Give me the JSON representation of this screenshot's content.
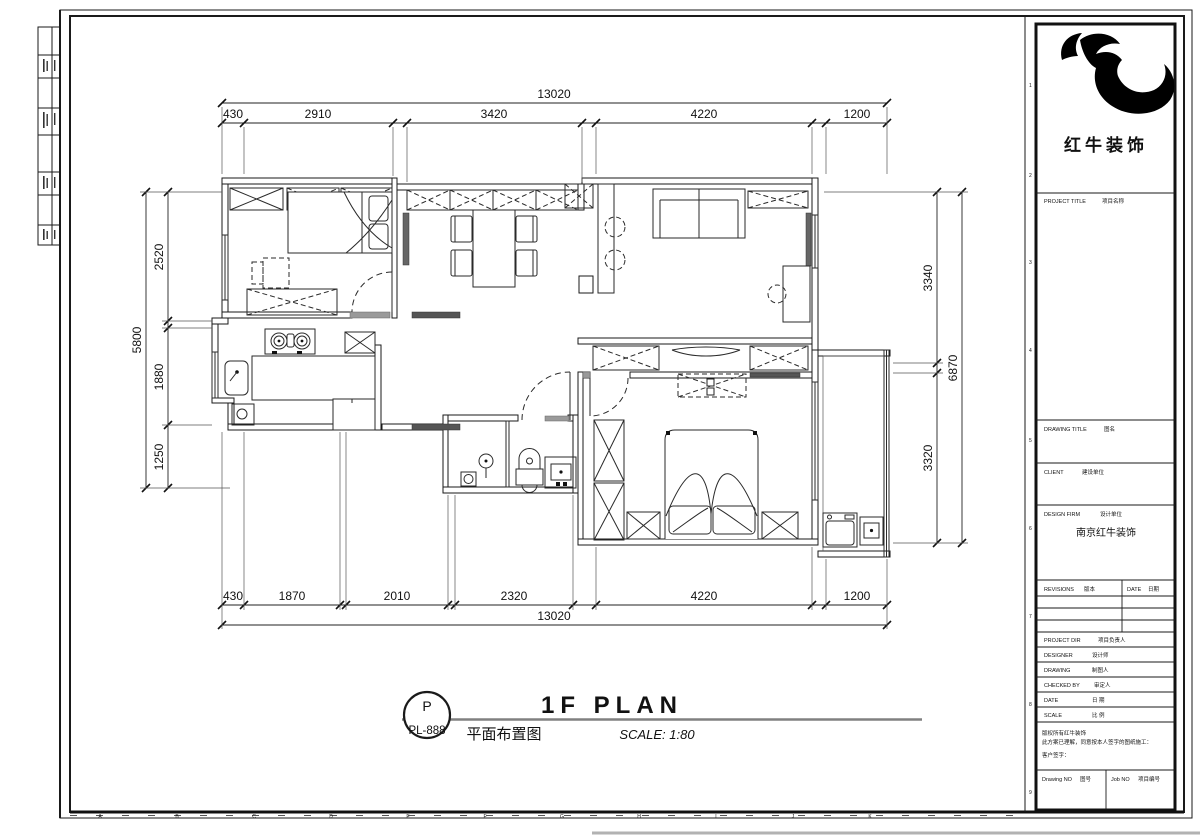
{
  "frame": {
    "ruler_letters": [
      "A",
      "B",
      "C",
      "D",
      "E",
      "F",
      "G",
      "H",
      "I",
      "J",
      "K"
    ],
    "row_numbers": [
      "1",
      "2",
      "3",
      "4",
      "5",
      "6",
      "7",
      "8",
      "9"
    ]
  },
  "plan": {
    "dims": {
      "top_total": "13020",
      "top_segments": [
        "430",
        "2910",
        "3420",
        "4220",
        "1200"
      ],
      "bottom_segments": [
        "430",
        "1870",
        "2010",
        "2320",
        "4220",
        "1200"
      ],
      "bottom_total": "13020",
      "left_total": "5800",
      "left_segments": [
        "2520",
        "1880",
        "1250"
      ],
      "right_segments": [
        "3340",
        "3320"
      ],
      "right_total": "6870"
    }
  },
  "caption": {
    "bubble_top": "P",
    "bubble_bottom": "PL-888",
    "title_en": "1F PLAN",
    "title_cn": "平面布置图",
    "scale": "SCALE: 1:80"
  },
  "titleblock": {
    "logo_text": "红牛装饰",
    "project_title_en": "PROJECT TITLE",
    "project_title_cn": "项目名称",
    "drawing_title_en": "DRAWING TITLE",
    "drawing_title_cn": "图名",
    "client_en": "CLIENT",
    "client_cn": "建设单位",
    "design_firm_en": "DESIGN FIRM",
    "design_firm_cn": "设计单位",
    "design_firm_value": "南京红牛装饰",
    "revisions_en": "REVISIONS",
    "revisions_cn": "版本",
    "date_col_en": "DATE",
    "date_col_cn": "日期",
    "project_dir_en": "PROJECT DIR",
    "project_dir_cn": "项目负责人",
    "designer_en": "DESIGNER",
    "designer_cn": "设计师",
    "drawing_en": "DRAWING",
    "drawing_cn": "制图人",
    "checked_en": "CHECKED BY",
    "checked_cn": "审定人",
    "date_en": "DATE",
    "date_cn": "日 期",
    "scale_en": "SCALE",
    "scale_cn": "比 例",
    "copyright_line1": "版权所有红牛装饰",
    "copyright_line2": "此方案已理解，同意按本人签字的图纸施工：",
    "signature_label": "客户签字：",
    "drawing_no_en": "Drawing NO",
    "drawing_no_cn": "图号",
    "job_no_en": "Job NO",
    "job_no_cn": "项目编号"
  }
}
